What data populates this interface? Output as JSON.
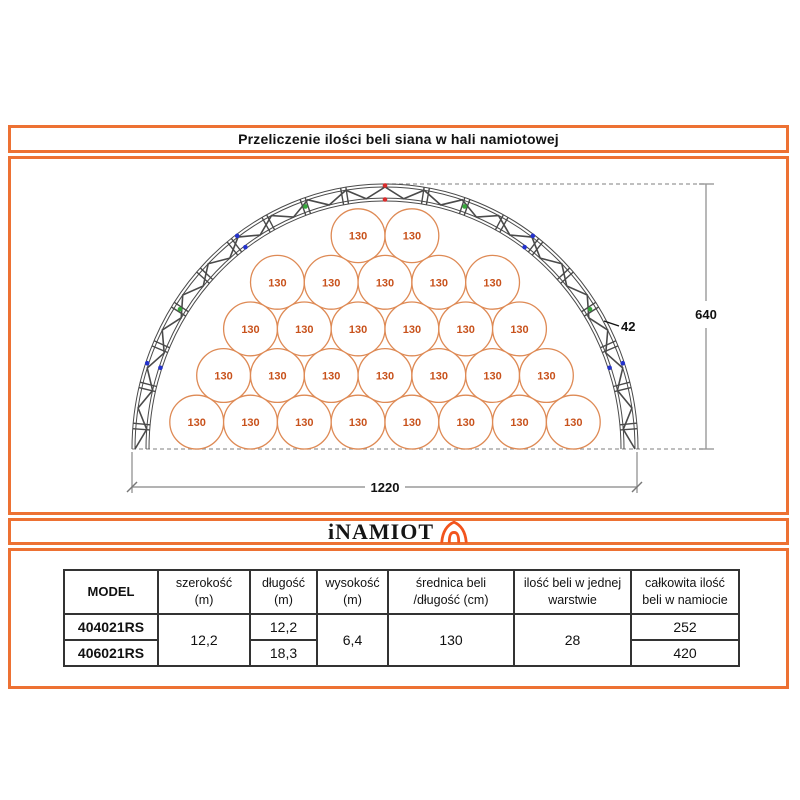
{
  "title": {
    "text": "Przeliczenie ilości beli siana w hali namiotowej"
  },
  "logo": {
    "text": "iNAMIOT",
    "icon": "tent-icon"
  },
  "colors": {
    "accent_orange": "#ED7133",
    "logo_tent_orange": "#F2541D",
    "bale_stroke": "#DE8A55",
    "bale_text": "#C8521C",
    "truss": "#4a4a4a",
    "dashed_line": "#999999",
    "dim_line": "#9a9a9a",
    "marker_red": "#D92B2B",
    "marker_green": "#35A83A",
    "marker_blue": "#2533CC"
  },
  "diagram": {
    "bale_label": "130",
    "bale_rows_top_to_bottom": [
      2,
      5,
      6,
      7,
      8
    ],
    "total_bales_in_layer": 28,
    "dim_width_cm": "1220",
    "dim_height_cm": "640",
    "dim_truss_cm": "42",
    "truss_markers": [
      {
        "angle_deg": 0,
        "color": "red",
        "band": "outer"
      },
      {
        "angle_deg": 0,
        "color": "red",
        "band": "inner"
      },
      {
        "angle_deg": -19,
        "color": "green",
        "band": "mid"
      },
      {
        "angle_deg": 19,
        "color": "green",
        "band": "mid"
      },
      {
        "angle_deg": -36,
        "color": "blue",
        "band": "outer"
      },
      {
        "angle_deg": -36,
        "color": "blue",
        "band": "inner"
      },
      {
        "angle_deg": 36,
        "color": "blue",
        "band": "outer"
      },
      {
        "angle_deg": 36,
        "color": "blue",
        "band": "inner"
      },
      {
        "angle_deg": -57,
        "color": "green",
        "band": "mid"
      },
      {
        "angle_deg": 57,
        "color": "green",
        "band": "mid"
      },
      {
        "angle_deg": -71,
        "color": "blue",
        "band": "outer"
      },
      {
        "angle_deg": -71,
        "color": "blue",
        "band": "inner"
      },
      {
        "angle_deg": 71,
        "color": "blue",
        "band": "outer"
      },
      {
        "angle_deg": 71,
        "color": "blue",
        "band": "inner"
      }
    ]
  },
  "table": {
    "headers": [
      "MODEL",
      "szerokość\n(m)",
      "długość\n(m)",
      "wysokość\n(m)",
      "średnica beli\n/długość (cm)",
      "ilość beli w jednej\nwarstwie",
      "całkowita ilość\nbeli w namiocie"
    ],
    "cells": {
      "model_1": "404021RS",
      "model_2": "406021RS",
      "szerokosc": "12,2",
      "dlugosc_1": "12,2",
      "dlugosc_2": "18,3",
      "wysokosc": "6,4",
      "srednica": "130",
      "ilosc_warstwa": "28",
      "calkowita_1": "252",
      "calkowita_2": "420"
    }
  }
}
